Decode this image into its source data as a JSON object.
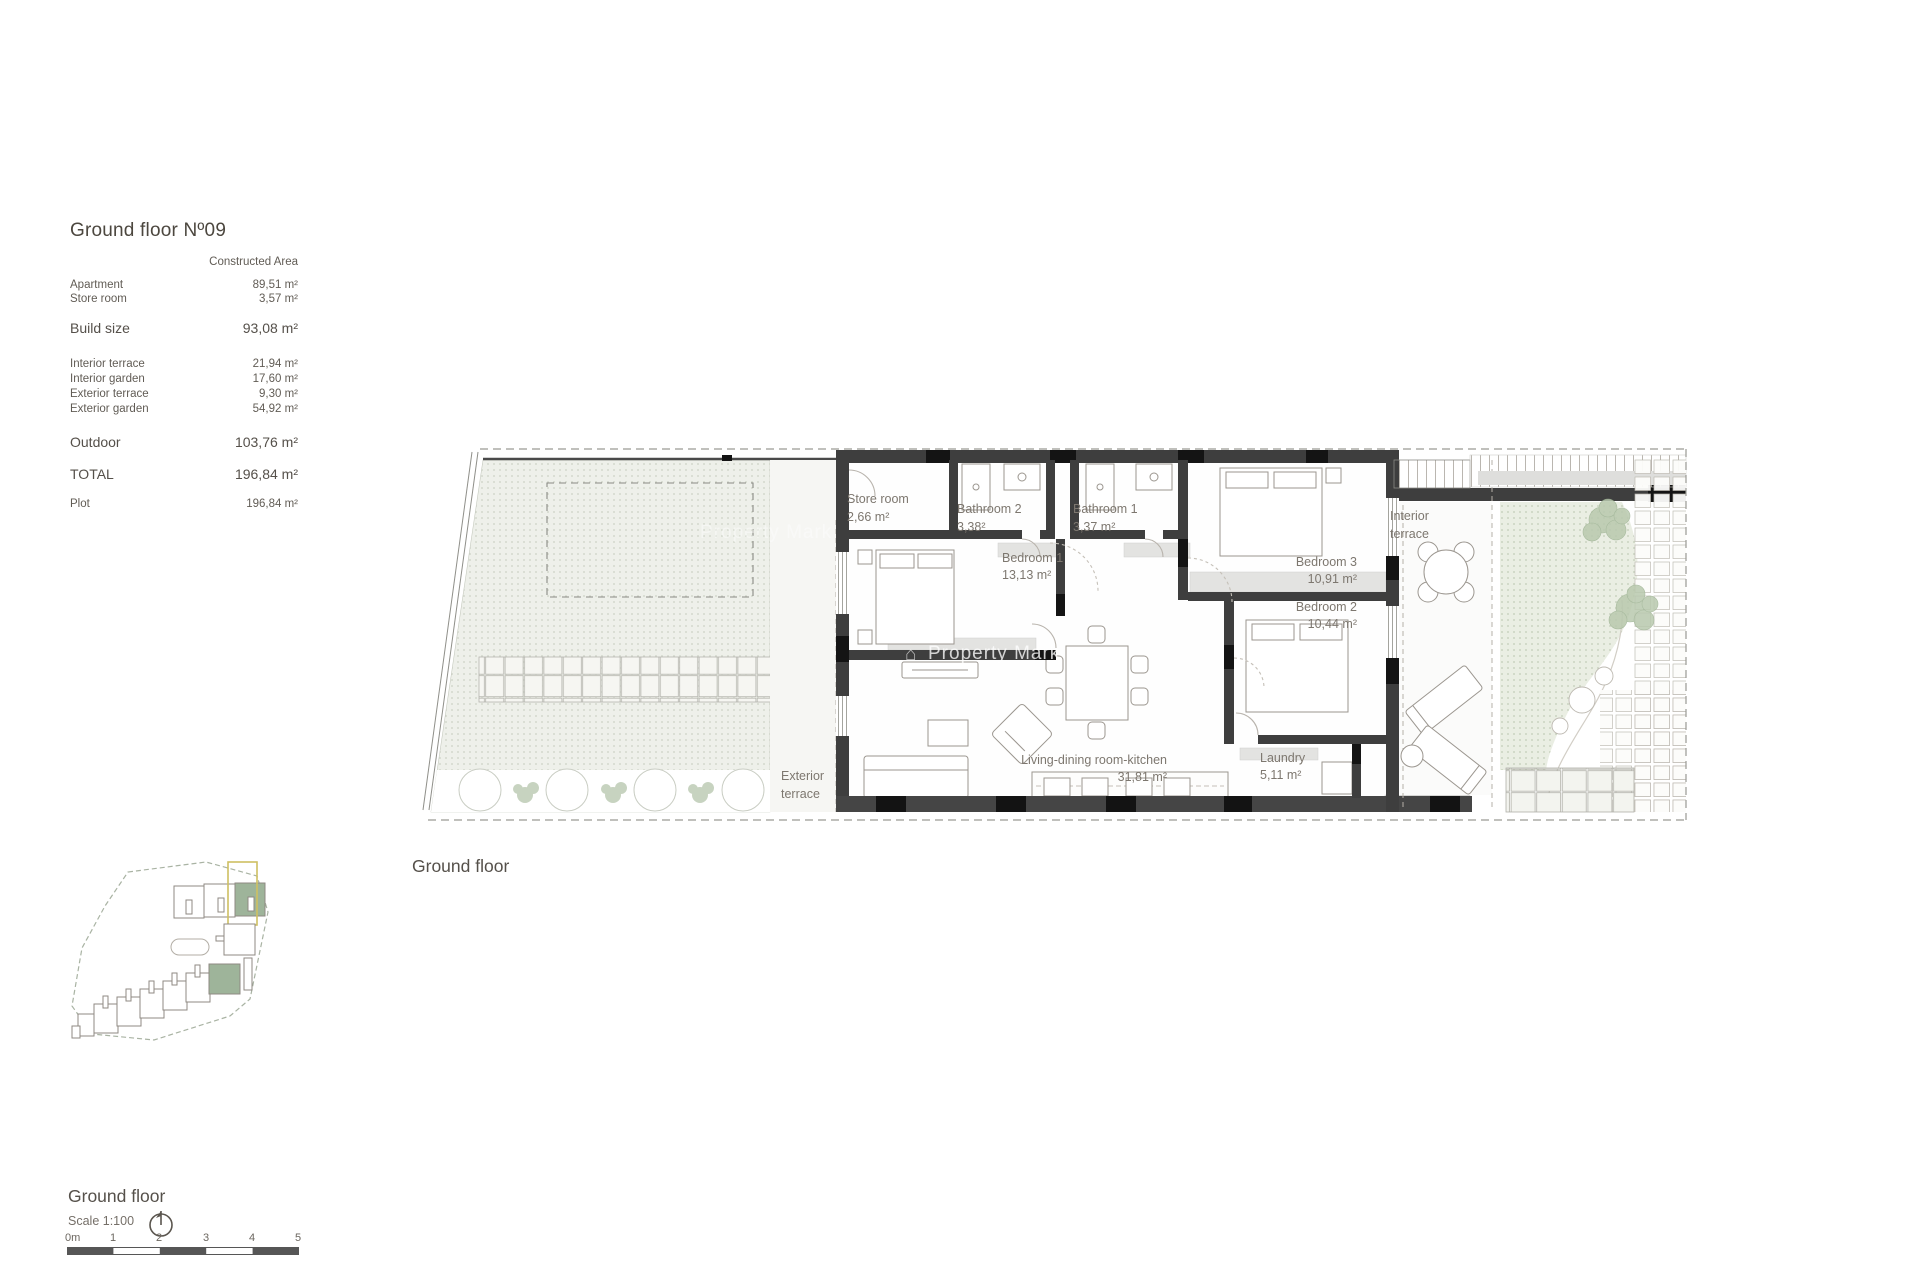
{
  "panel": {
    "title": "Ground floor Nº09",
    "col_header": "Constructed Area",
    "rows": [
      {
        "label": "Apartment",
        "value": "89,51 m²"
      },
      {
        "label": "Store room",
        "value": "3,57 m²"
      },
      {
        "label": "Build size",
        "value": "93,08 m²"
      },
      {
        "label": "Interior terrace",
        "value": "21,94 m²"
      },
      {
        "label": "Interior garden",
        "value": "17,60 m²"
      },
      {
        "label": "Exterior terrace",
        "value": "9,30 m²"
      },
      {
        "label": "Exterior garden",
        "value": "54,92 m²"
      },
      {
        "label": "Outdoor",
        "value": "103,76 m²"
      },
      {
        "label": "TOTAL",
        "value": "196,84 m²"
      },
      {
        "label": "Plot",
        "value": "196,84 m²"
      }
    ]
  },
  "plan": {
    "caption": "Ground floor",
    "watermark": "Property Mark",
    "rooms": {
      "store_room": {
        "name": "Store room",
        "area": "2,66 m²"
      },
      "bathroom2": {
        "name": "Bathroom 2",
        "area": "3,38²"
      },
      "bathroom1": {
        "name": "Bathroom 1",
        "area": "3,37 m²"
      },
      "bedroom1": {
        "name": "Bedroom 1",
        "area": "13,13 m²"
      },
      "bedroom3": {
        "name": "Bedroom 3",
        "area": "10,91 m²"
      },
      "bedroom2": {
        "name": "Bedroom 2",
        "area": "10,44 m²"
      },
      "living": {
        "name": "Living-dining room-kitchen",
        "area": "31,81 m²"
      },
      "laundry": {
        "name": "Laundry",
        "area": "5,11 m²"
      },
      "interior_terrace": {
        "l1": "Interior",
        "l2": "terrace"
      },
      "exterior_terrace": {
        "l1": "Exterior",
        "l2": "terrace"
      }
    }
  },
  "footer": {
    "title": "Ground floor",
    "scale": "Scale 1:100",
    "ticks": [
      "0m",
      "1",
      "2",
      "3",
      "4",
      "5"
    ]
  },
  "colors": {
    "wall": "#3e3e3e",
    "site_unit_green": "#9eb49a",
    "site_highlight_yellow": "#cfc062"
  }
}
